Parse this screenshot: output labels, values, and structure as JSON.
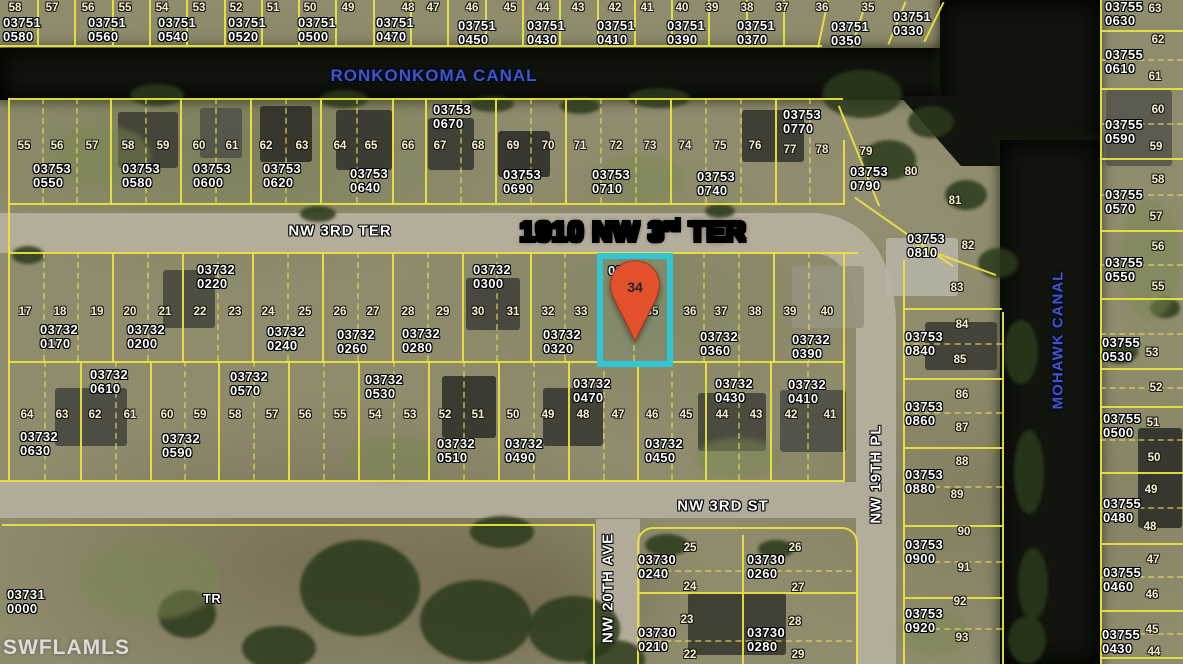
{
  "map_title": {
    "full_text": "1910 NW 3rd TER",
    "part1": "1910 NW 3",
    "sup": "rd",
    "part2": " TER",
    "x": 633,
    "y": 216
  },
  "watermark": {
    "text": "SWFLAMLS",
    "x": 3,
    "y": 636
  },
  "highlight": {
    "parcel_label": "03732",
    "pin_lot": "34",
    "border_color": "#2fc6d8",
    "pin_color": "#e2512b",
    "rect": {
      "x": 597,
      "y": 253,
      "w": 76,
      "h": 114
    }
  },
  "canal_labels": [
    {
      "name": "RONKONKOMA CANAL",
      "x": 434,
      "y": 76,
      "rotate": 0,
      "size": 17
    },
    {
      "name": "MOHAWK CANAL",
      "x": 1058,
      "y": 340,
      "rotate": -90,
      "size": 15
    }
  ],
  "street_labels": [
    {
      "name": "NW 3RD TER",
      "x": 340,
      "y": 231,
      "rotate": 0
    },
    {
      "name": "NW 3RD ST",
      "x": 723,
      "y": 506,
      "rotate": 0
    },
    {
      "name": "NW 20TH AVE",
      "x": 608,
      "y": 588,
      "rotate": -90
    },
    {
      "name": "NW 19TH PL",
      "x": 876,
      "y": 474,
      "rotate": -90
    }
  ],
  "misc_labels": [
    {
      "l1": "03731",
      "l2": "0000",
      "x": 7,
      "y": 588
    },
    {
      "l1": "TR",
      "l2": "",
      "x": 203,
      "y": 592
    }
  ],
  "parcel_labels": [
    [
      "03751",
      "0580",
      3,
      16
    ],
    [
      "03751",
      "0560",
      88,
      16
    ],
    [
      "03751",
      "0540",
      158,
      16
    ],
    [
      "03751",
      "0520",
      228,
      16
    ],
    [
      "03751",
      "0500",
      298,
      16
    ],
    [
      "03751",
      "0470",
      376,
      16
    ],
    [
      "03751",
      "0450",
      458,
      19
    ],
    [
      "03751",
      "0430",
      527,
      19
    ],
    [
      "03751",
      "0410",
      597,
      19
    ],
    [
      "03751",
      "0390",
      667,
      19
    ],
    [
      "03751",
      "0370",
      737,
      19
    ],
    [
      "03751",
      "0350",
      831,
      20
    ],
    [
      "03751",
      "0330",
      893,
      10
    ],
    [
      "03753",
      "0550",
      33,
      162
    ],
    [
      "03753",
      "0580",
      122,
      162
    ],
    [
      "03753",
      "0600",
      193,
      162
    ],
    [
      "03753",
      "0620",
      263,
      162
    ],
    [
      "03753",
      "0640",
      350,
      167
    ],
    [
      "03753",
      "0670",
      433,
      103
    ],
    [
      "03753",
      "0690",
      503,
      168
    ],
    [
      "03753",
      "0710",
      592,
      168
    ],
    [
      "03753",
      "0740",
      697,
      170
    ],
    [
      "03753",
      "0770",
      783,
      108
    ],
    [
      "03753",
      "0790",
      850,
      165
    ],
    [
      "03753",
      "0810",
      907,
      232
    ],
    [
      "03732",
      "0220",
      197,
      263
    ],
    [
      "03732",
      "0300",
      473,
      263
    ],
    [
      "03732",
      "0170",
      40,
      323
    ],
    [
      "03732",
      "0200",
      127,
      323
    ],
    [
      "03732",
      "0240",
      267,
      325
    ],
    [
      "03732",
      "0260",
      337,
      328
    ],
    [
      "03732",
      "0280",
      402,
      327
    ],
    [
      "03732",
      "0320",
      543,
      328
    ],
    [
      "03732",
      "0360",
      700,
      330
    ],
    [
      "03732",
      "0390",
      792,
      333
    ],
    [
      "03732",
      "0610",
      90,
      368
    ],
    [
      "03732",
      "0570",
      230,
      370
    ],
    [
      "03732",
      "0530",
      365,
      373
    ],
    [
      "03732",
      "0470",
      573,
      377
    ],
    [
      "03732",
      "0430",
      715,
      377
    ],
    [
      "03732",
      "0410",
      788,
      378
    ],
    [
      "03732",
      "0630",
      20,
      430
    ],
    [
      "03732",
      "0590",
      162,
      432
    ],
    [
      "03732",
      "0510",
      437,
      437
    ],
    [
      "03732",
      "0490",
      505,
      437
    ],
    [
      "03732",
      "0450",
      645,
      437
    ],
    [
      "03730",
      "0240",
      638,
      553
    ],
    [
      "03730",
      "0260",
      747,
      553
    ],
    [
      "03730",
      "0210",
      638,
      626
    ],
    [
      "03730",
      "0280",
      747,
      626
    ],
    [
      "03753",
      "0840",
      905,
      330
    ],
    [
      "03753",
      "0860",
      905,
      400
    ],
    [
      "03753",
      "0880",
      905,
      468
    ],
    [
      "03753",
      "0900",
      905,
      538
    ],
    [
      "03753",
      "0920",
      905,
      607
    ],
    [
      "03755",
      "0630",
      1105,
      0
    ],
    [
      "03755",
      "0610",
      1105,
      48
    ],
    [
      "03755",
      "0590",
      1105,
      118
    ],
    [
      "03755",
      "0570",
      1105,
      188
    ],
    [
      "03755",
      "0550",
      1105,
      256
    ],
    [
      "03755",
      "0530",
      1102,
      336
    ],
    [
      "03755",
      "0500",
      1103,
      412
    ],
    [
      "03755",
      "0480",
      1103,
      497
    ],
    [
      "03755",
      "0460",
      1103,
      566
    ],
    [
      "03755",
      "0430",
      1102,
      628
    ]
  ],
  "lot_numbers": [
    [
      "58",
      15,
      8
    ],
    [
      "57",
      52,
      8
    ],
    [
      "56",
      88,
      8
    ],
    [
      "55",
      125,
      8
    ],
    [
      "54",
      162,
      8
    ],
    [
      "53",
      199,
      8
    ],
    [
      "52",
      236,
      8
    ],
    [
      "51",
      273,
      8
    ],
    [
      "50",
      310,
      8
    ],
    [
      "49",
      348,
      8
    ],
    [
      "48",
      408,
      8
    ],
    [
      "47",
      433,
      8
    ],
    [
      "46",
      472,
      8
    ],
    [
      "45",
      510,
      8
    ],
    [
      "44",
      543,
      8
    ],
    [
      "43",
      578,
      8
    ],
    [
      "42",
      615,
      8
    ],
    [
      "41",
      647,
      8
    ],
    [
      "40",
      682,
      8
    ],
    [
      "39",
      712,
      8
    ],
    [
      "38",
      747,
      8
    ],
    [
      "37",
      782,
      8
    ],
    [
      "36",
      822,
      8
    ],
    [
      "35",
      868,
      8
    ],
    [
      "55",
      24,
      146
    ],
    [
      "56",
      57,
      146
    ],
    [
      "57",
      92,
      146
    ],
    [
      "58",
      128,
      146
    ],
    [
      "59",
      163,
      146
    ],
    [
      "60",
      199,
      146
    ],
    [
      "61",
      232,
      146
    ],
    [
      "62",
      266,
      146
    ],
    [
      "63",
      302,
      146
    ],
    [
      "64",
      340,
      146
    ],
    [
      "65",
      371,
      146
    ],
    [
      "66",
      408,
      146
    ],
    [
      "67",
      440,
      146
    ],
    [
      "68",
      478,
      146
    ],
    [
      "69",
      513,
      146
    ],
    [
      "70",
      548,
      146
    ],
    [
      "71",
      580,
      146
    ],
    [
      "72",
      616,
      146
    ],
    [
      "73",
      650,
      146
    ],
    [
      "74",
      685,
      146
    ],
    [
      "75",
      720,
      146
    ],
    [
      "76",
      755,
      146
    ],
    [
      "77",
      790,
      150
    ],
    [
      "78",
      822,
      150
    ],
    [
      "79",
      866,
      152
    ],
    [
      "80",
      911,
      172
    ],
    [
      "81",
      955,
      201
    ],
    [
      "82",
      968,
      246
    ],
    [
      "17",
      25,
      312
    ],
    [
      "18",
      60,
      312
    ],
    [
      "19",
      97,
      312
    ],
    [
      "20",
      130,
      312
    ],
    [
      "21",
      165,
      312
    ],
    [
      "22",
      200,
      312
    ],
    [
      "23",
      235,
      312
    ],
    [
      "24",
      268,
      312
    ],
    [
      "25",
      305,
      312
    ],
    [
      "26",
      340,
      312
    ],
    [
      "27",
      373,
      312
    ],
    [
      "28",
      408,
      312
    ],
    [
      "29",
      443,
      312
    ],
    [
      "30",
      478,
      312
    ],
    [
      "31",
      513,
      312
    ],
    [
      "32",
      548,
      312
    ],
    [
      "33",
      581,
      312
    ],
    [
      "35",
      652,
      312
    ],
    [
      "36",
      690,
      312
    ],
    [
      "37",
      721,
      312
    ],
    [
      "38",
      755,
      312
    ],
    [
      "39",
      790,
      312
    ],
    [
      "40",
      827,
      312
    ],
    [
      "64",
      27,
      415
    ],
    [
      "63",
      62,
      415
    ],
    [
      "62",
      95,
      415
    ],
    [
      "61",
      130,
      415
    ],
    [
      "60",
      167,
      415
    ],
    [
      "59",
      200,
      415
    ],
    [
      "58",
      235,
      415
    ],
    [
      "57",
      272,
      415
    ],
    [
      "56",
      305,
      415
    ],
    [
      "55",
      340,
      415
    ],
    [
      "54",
      375,
      415
    ],
    [
      "53",
      410,
      415
    ],
    [
      "52",
      445,
      415
    ],
    [
      "51",
      478,
      415
    ],
    [
      "50",
      513,
      415
    ],
    [
      "49",
      548,
      415
    ],
    [
      "48",
      583,
      415
    ],
    [
      "47",
      618,
      415
    ],
    [
      "46",
      652,
      415
    ],
    [
      "45",
      686,
      415
    ],
    [
      "44",
      722,
      415
    ],
    [
      "43",
      756,
      415
    ],
    [
      "42",
      791,
      415
    ],
    [
      "41",
      830,
      415
    ],
    [
      "25",
      690,
      548
    ],
    [
      "24",
      690,
      587
    ],
    [
      "26",
      795,
      548
    ],
    [
      "27",
      798,
      588
    ],
    [
      "23",
      687,
      620
    ],
    [
      "22",
      690,
      655
    ],
    [
      "28",
      795,
      622
    ],
    [
      "29",
      798,
      655
    ],
    [
      "83",
      957,
      288
    ],
    [
      "84",
      962,
      325
    ],
    [
      "85",
      960,
      360
    ],
    [
      "86",
      962,
      395
    ],
    [
      "87",
      962,
      428
    ],
    [
      "88",
      962,
      462
    ],
    [
      "89",
      957,
      495
    ],
    [
      "90",
      964,
      532
    ],
    [
      "91",
      964,
      568
    ],
    [
      "92",
      960,
      602
    ],
    [
      "93",
      962,
      638
    ],
    [
      "63",
      1155,
      9
    ],
    [
      "62",
      1158,
      40
    ],
    [
      "61",
      1155,
      77
    ],
    [
      "60",
      1158,
      110
    ],
    [
      "59",
      1156,
      147
    ],
    [
      "58",
      1158,
      180
    ],
    [
      "57",
      1156,
      217
    ],
    [
      "56",
      1158,
      247
    ],
    [
      "55",
      1158,
      287
    ],
    [
      "53",
      1152,
      353
    ],
    [
      "52",
      1156,
      388
    ],
    [
      "51",
      1153,
      423
    ],
    [
      "50",
      1154,
      458
    ],
    [
      "49",
      1151,
      490
    ],
    [
      "48",
      1150,
      527
    ],
    [
      "47",
      1153,
      560
    ],
    [
      "46",
      1152,
      595
    ],
    [
      "45",
      1152,
      630
    ],
    [
      "44",
      1154,
      652
    ]
  ]
}
